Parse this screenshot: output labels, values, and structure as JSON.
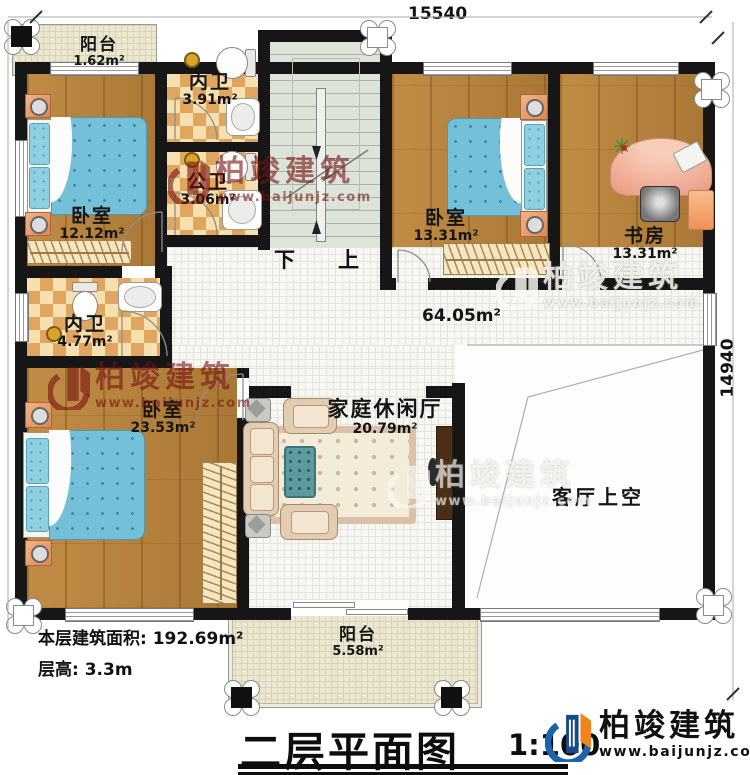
{
  "title": {
    "text": "二层平面图",
    "scale": "1:100"
  },
  "dimensions": {
    "top": "15540",
    "right": "14940"
  },
  "info": {
    "floor_area": "本层建筑面积: 192.69m²",
    "floor_height": "层高: 3.3m"
  },
  "rooms": {
    "balcony_top": {
      "name": "阳台",
      "area": "1.62m²"
    },
    "bath_inner_top": {
      "name": "内卫",
      "area": "3.91m²"
    },
    "bath_public": {
      "name": "公卫",
      "area": "3.06m²"
    },
    "bedroom_tl": {
      "name": "卧室",
      "area": "12.12m²"
    },
    "bedroom_tm": {
      "name": "卧室",
      "area": "13.31m²"
    },
    "study": {
      "name": "书房",
      "area": "13.31m²"
    },
    "bath_inner_left": {
      "name": "内卫",
      "area": "4.77m²"
    },
    "bedroom_bl": {
      "name": "卧室",
      "area": "23.53m²"
    },
    "family_hall": {
      "name": "家庭休闲厅",
      "area": "20.79m²"
    },
    "hall": {
      "area": "64.05m²"
    },
    "living_void": {
      "name": "客厅上空"
    },
    "balcony_bottom": {
      "name": "阳台",
      "area": "5.58m²"
    }
  },
  "stairs": {
    "down_label": "下",
    "up_label": "上"
  },
  "brand": {
    "name": "柏竣建筑",
    "url": "www.baijunjz.com"
  },
  "colors": {
    "wall": "#161616",
    "watermark_red": "#761212",
    "wood": "#b5813f",
    "checker_dark": "#e0a55f",
    "stair": "#dde3d8",
    "bed_blue": "#74c0d9",
    "logo_blue": "#1c63ad",
    "logo_orange": "#f08519"
  }
}
